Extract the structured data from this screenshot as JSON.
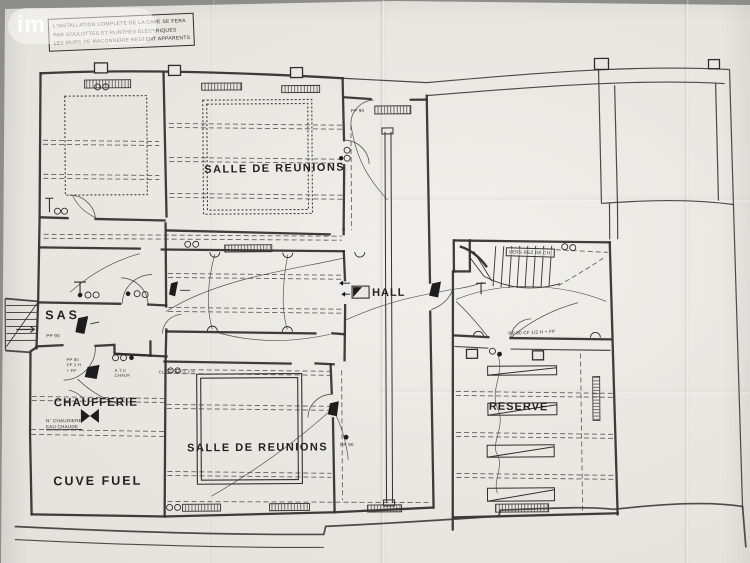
{
  "watermark": {
    "text": "im"
  },
  "title_block": {
    "line1": "L'INSTALLATION COMPLETE DE LA CAVE SE FERA",
    "line2": "PAR GOULOTTES ET PLINTHES ELECTRIQUES",
    "line3": "LES MURS DE MACONNERIE RESTENT APPARENTS"
  },
  "rooms": {
    "salle_reunions_top": "SALLE DE REUNIONS",
    "salle_reunions_bottom": "SALLE DE REUNIONS",
    "sas": "SAS",
    "chaufferie": "CHAUFFERIE",
    "cuve_fuel": "CUVE FUEL",
    "hall": "HALL",
    "reserve": "RESERVE"
  },
  "annotations": {
    "vers_rez_de_ch": "VERS REZ DE CH.",
    "pp90_sas": "PP 90",
    "pp90_corridor": "PP 90",
    "pp90_salle": "PP 90",
    "pp80_chaufferie_l1": "PP 80",
    "pp80_chaufferie_l2": "CF 1 H",
    "pp80_chaufferie_l3": "+ FP",
    "pp80_reserve": "PP 80 CF 1/2 H + FP",
    "atu_l1": "A.T.U",
    "atu_l2": "CHAUF.",
    "cloison": "CLOISON CF 2 H",
    "chaudiere_l1": "N° CHAUDIERE",
    "chaudiere_l2": "EAU CHAUDE"
  },
  "colors": {
    "paper": "#eae8e3",
    "ink": "#2f2f2f",
    "background": "#8d8d8b"
  }
}
